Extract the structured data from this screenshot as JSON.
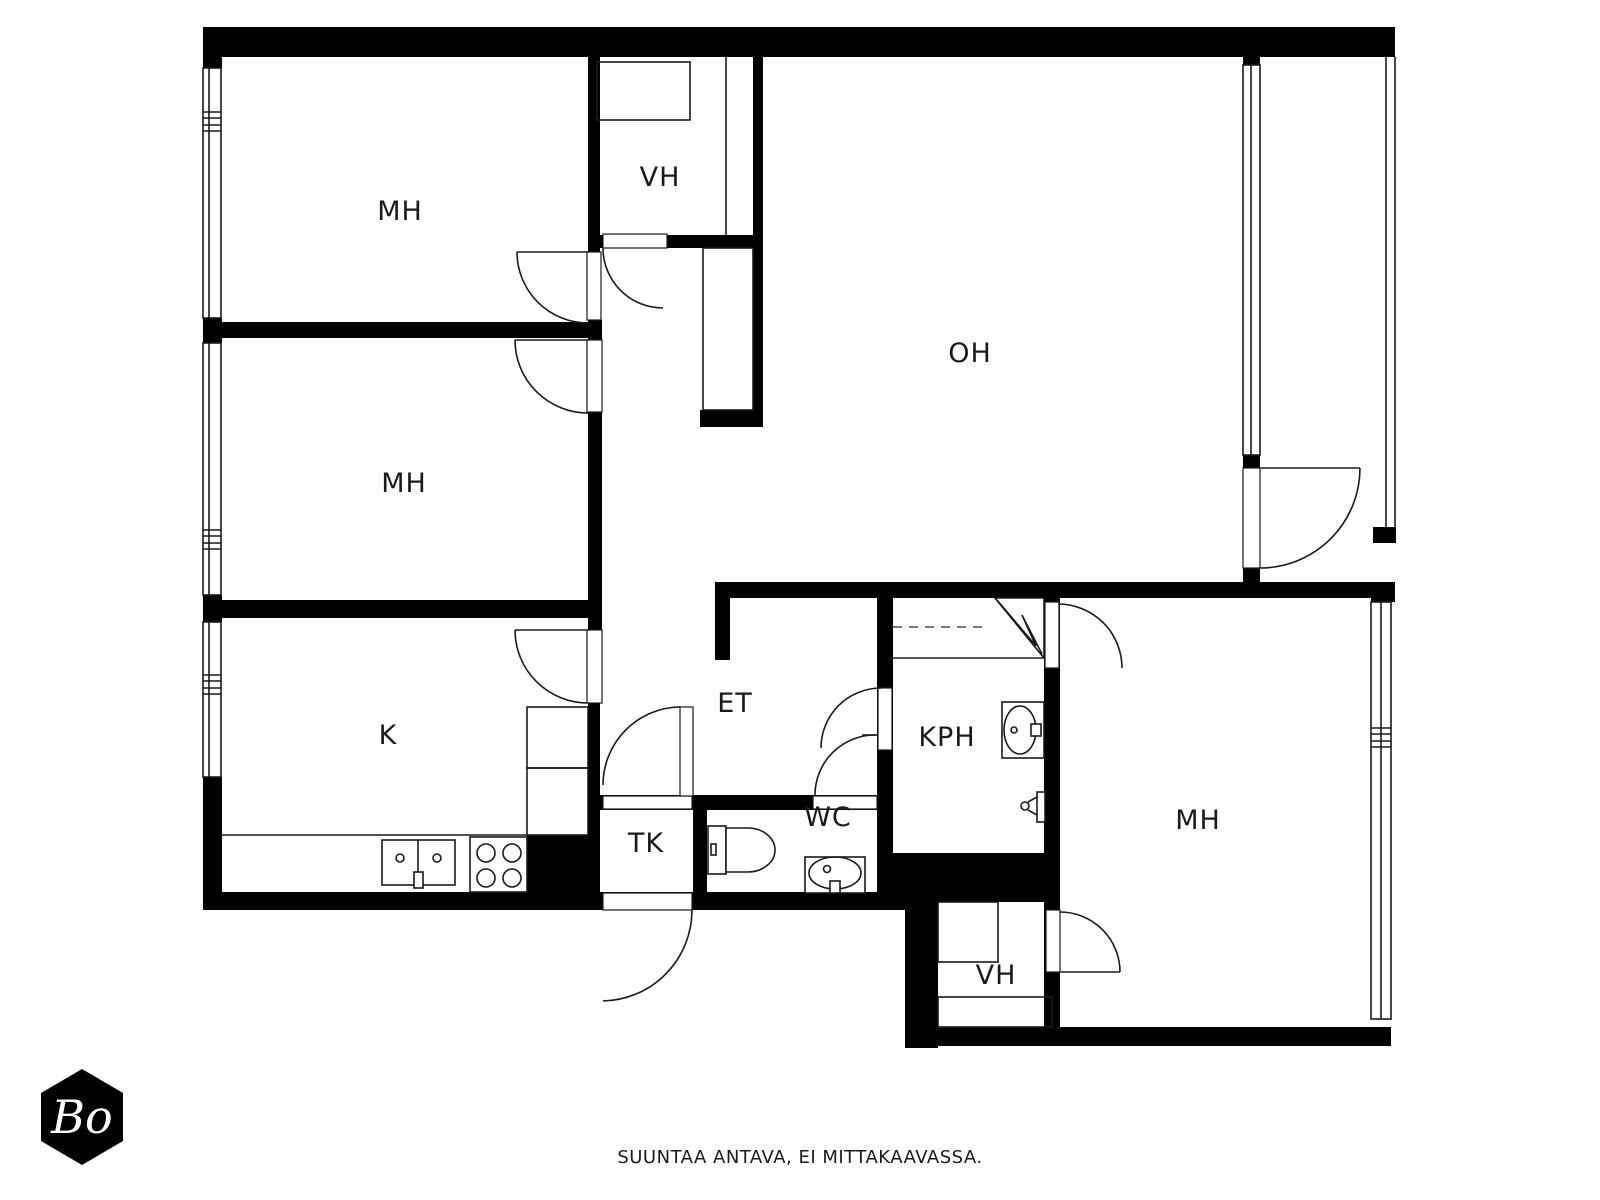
{
  "document": {
    "type": "floor-plan",
    "footer_disclaimer": "SUUNTAA ANTAVA, EI MITTAKAAVASSA.",
    "logo_text": "Bo"
  },
  "colors": {
    "wall": "#000000",
    "background": "#ffffff",
    "line": "#1a1a1a"
  },
  "rooms": [
    {
      "id": "mh-top-left",
      "label": "MH"
    },
    {
      "id": "vh-top",
      "label": "VH"
    },
    {
      "id": "oh-living",
      "label": "OH"
    },
    {
      "id": "mh-middle-left",
      "label": "MH"
    },
    {
      "id": "k-kitchen",
      "label": "K"
    },
    {
      "id": "et-hall",
      "label": "ET"
    },
    {
      "id": "kph-bathroom",
      "label": "KPH"
    },
    {
      "id": "tk-closet",
      "label": "TK"
    },
    {
      "id": "wc-toilet",
      "label": "WC"
    },
    {
      "id": "vh-bottom",
      "label": "VH"
    },
    {
      "id": "mh-bottom-right",
      "label": "MH"
    }
  ]
}
